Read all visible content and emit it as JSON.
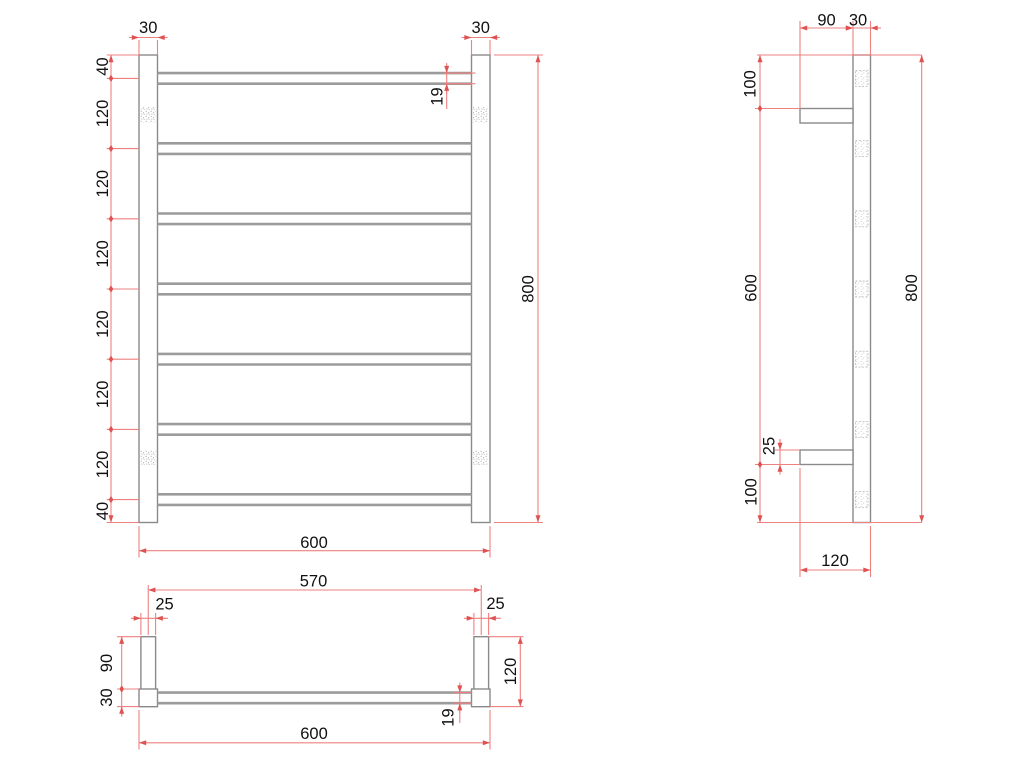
{
  "drawing_type": "technical-drawing",
  "subject": "ladder-towel-rail",
  "colors": {
    "background": "#ffffff",
    "dim_line": "#ef8080",
    "dim_arrow": "#e05252",
    "object_line": "#8a8a8a",
    "tube_line": "#9b9b9b",
    "object_fill": "#ffffff",
    "text": "#111111",
    "stipple_dot": "#b2b2b2",
    "stipple_dot_light": "#cfcfcf",
    "dash_border": "#c4c4c4"
  },
  "views": [
    {
      "name": "front-view",
      "rects": [
        {
          "n": "left-post",
          "x": 139,
          "y": 55,
          "w": 18.5,
          "h": 467.5
        },
        {
          "n": "right-post",
          "x": 471.5,
          "y": 55,
          "w": 18.5,
          "h": 467.5
        }
      ],
      "tube_lines": {
        "x1": 157.5,
        "x2": 471.5,
        "offset": 5.3,
        "centers": [
          78.4,
          148.6,
          218.8,
          289,
          359.2,
          429.4,
          499.6
        ]
      },
      "stipples": [
        {
          "x": 140.7,
          "y": 107,
          "w": 15.2,
          "h": 15.5
        },
        {
          "x": 140.7,
          "y": 450,
          "w": 15.2,
          "h": 15.5
        },
        {
          "x": 472.6,
          "y": 107,
          "w": 15.2,
          "h": 15.5
        },
        {
          "x": 472.6,
          "y": 450,
          "w": 15.2,
          "h": 15.5
        }
      ],
      "ext_lines": [
        [
          139,
          40,
          139,
          55
        ],
        [
          157.5,
          40,
          157.5,
          55
        ],
        [
          471.5,
          40,
          471.5,
          55
        ],
        [
          490,
          40,
          490,
          55
        ],
        [
          106.7,
          55,
          139,
          55
        ],
        [
          106.7,
          78.4,
          139,
          78.4
        ],
        [
          106.7,
          148.6,
          139,
          148.6
        ],
        [
          106.7,
          218.8,
          139,
          218.8
        ],
        [
          106.7,
          289,
          139,
          289
        ],
        [
          106.7,
          359.2,
          139,
          359.2
        ],
        [
          106.7,
          429.4,
          139,
          429.4
        ],
        [
          106.7,
          499.6,
          139,
          499.6
        ],
        [
          106.7,
          522.5,
          139,
          522.5
        ],
        [
          443,
          73.1,
          475.5,
          73.1
        ],
        [
          443,
          83.7,
          475.5,
          83.7
        ],
        [
          494,
          55,
          543,
          55
        ],
        [
          494,
          522.5,
          543,
          522.5
        ],
        [
          139,
          526,
          139,
          557.5
        ],
        [
          490,
          526,
          490,
          557.5
        ]
      ],
      "dims": [
        {
          "n": "post-width-left",
          "t": "30",
          "o": "h",
          "a": 139,
          "b": 157.5,
          "p": 37.5,
          "e": [
            "out",
            "out"
          ],
          "l": [
            148.2,
            28
          ]
        },
        {
          "n": "post-width-right",
          "t": "30",
          "o": "h",
          "a": 471.5,
          "b": 490,
          "p": 37.5,
          "e": [
            "out",
            "out"
          ],
          "l": [
            480.7,
            28
          ]
        },
        {
          "n": "top-rung-offset",
          "t": "40",
          "o": "v",
          "a": 55,
          "b": 78.4,
          "p": 111,
          "e": [
            "in",
            "diamond"
          ],
          "l": [
            103,
            66.5
          ]
        },
        {
          "n": "rung-pitch-1",
          "t": "120",
          "o": "v",
          "a": 78.4,
          "b": 148.6,
          "p": 111,
          "e": [
            "diamond",
            "diamond"
          ],
          "l": [
            103,
            113.5
          ]
        },
        {
          "n": "rung-pitch-2",
          "t": "120",
          "o": "v",
          "a": 148.6,
          "b": 218.8,
          "p": 111,
          "e": [
            "diamond",
            "diamond"
          ],
          "l": [
            103,
            183.7
          ]
        },
        {
          "n": "rung-pitch-3",
          "t": "120",
          "o": "v",
          "a": 218.8,
          "b": 289,
          "p": 111,
          "e": [
            "diamond",
            "diamond"
          ],
          "l": [
            103,
            253.9
          ]
        },
        {
          "n": "rung-pitch-4",
          "t": "120",
          "o": "v",
          "a": 289,
          "b": 359.2,
          "p": 111,
          "e": [
            "diamond",
            "diamond"
          ],
          "l": [
            103,
            324.1
          ]
        },
        {
          "n": "rung-pitch-5",
          "t": "120",
          "o": "v",
          "a": 359.2,
          "b": 429.4,
          "p": 111,
          "e": [
            "diamond",
            "diamond"
          ],
          "l": [
            103,
            394.3
          ]
        },
        {
          "n": "rung-pitch-6",
          "t": "120",
          "o": "v",
          "a": 429.4,
          "b": 499.6,
          "p": 111,
          "e": [
            "diamond",
            "diamond"
          ],
          "l": [
            103,
            464.5
          ]
        },
        {
          "n": "bottom-rung-offset",
          "t": "40",
          "o": "v",
          "a": 499.6,
          "b": 522.5,
          "p": 111,
          "e": [
            "diamond",
            "in"
          ],
          "l": [
            103,
            511
          ]
        },
        {
          "n": "tube-diameter",
          "t": "19",
          "o": "v",
          "a": 73.1,
          "b": 83.7,
          "p": 446.7,
          "e": [
            "out",
            "out"
          ],
          "l": [
            437.5,
            96.5
          ],
          "tail": [
            83.7,
            109
          ]
        },
        {
          "n": "overall-height",
          "t": "800",
          "o": "v",
          "a": 55,
          "b": 522.5,
          "p": 538,
          "e": [
            "in",
            "in"
          ],
          "l": [
            528.5,
            289
          ]
        },
        {
          "n": "overall-width",
          "t": "600",
          "o": "h",
          "a": 139,
          "b": 490,
          "p": 550.7,
          "e": [
            "in",
            "in"
          ],
          "l": [
            314,
            543
          ]
        }
      ]
    },
    {
      "name": "side-view",
      "rects": [
        {
          "n": "wall-rail",
          "x": 853,
          "y": 55,
          "w": 17.5,
          "h": 467.5
        },
        {
          "n": "upper-bracket",
          "x": 800,
          "y": 108.5,
          "w": 53,
          "h": 14.5
        },
        {
          "n": "lower-bracket",
          "x": 800,
          "y": 450,
          "w": 53,
          "h": 14.5
        }
      ],
      "dashed_squares": {
        "x": 855.5,
        "w": 12.5,
        "h": 16,
        "centers": [
          78.4,
          148.6,
          218.8,
          289,
          359.2,
          429.4,
          499.6
        ]
      },
      "ext_lines": [
        [
          800,
          21,
          800,
          108.5
        ],
        [
          853,
          21,
          853,
          55
        ],
        [
          870.5,
          21,
          870.5,
          55
        ],
        [
          757,
          55,
          921.7,
          55
        ],
        [
          757,
          522.5,
          921.7,
          522.5
        ],
        [
          755,
          108.5,
          800,
          108.5
        ],
        [
          755,
          464.5,
          800,
          464.5
        ],
        [
          775,
          450,
          800,
          450
        ],
        [
          800,
          468,
          800,
          577
        ],
        [
          870.5,
          526,
          870.5,
          577
        ]
      ],
      "dims": [
        {
          "n": "bracket-projection",
          "t": "90",
          "o": "h",
          "a": 800,
          "b": 853,
          "p": 28,
          "e": [
            "in",
            "in"
          ],
          "l": [
            826.5,
            20.5
          ]
        },
        {
          "n": "rail-depth",
          "t": "30",
          "o": "h",
          "a": 853,
          "b": 870.5,
          "p": 28,
          "e": [
            "out",
            "out"
          ],
          "l": [
            858,
            20.5
          ],
          "tail": [
            870.5,
            881
          ]
        },
        {
          "n": "top-bracket-offset",
          "t": "100",
          "o": "v",
          "a": 55,
          "b": 108.5,
          "p": 760,
          "e": [
            "in",
            "diamond"
          ],
          "l": [
            750.5,
            84
          ]
        },
        {
          "n": "bracket-spacing",
          "t": "600",
          "o": "v",
          "a": 108.5,
          "b": 464.5,
          "p": 760,
          "e": [
            "diamond",
            "diamond"
          ],
          "l": [
            751.5,
            288
          ]
        },
        {
          "n": "bottom-bracket-offset",
          "t": "100",
          "o": "v",
          "a": 464.5,
          "b": 522.5,
          "p": 760,
          "e": [
            "diamond",
            "in"
          ],
          "l": [
            751.5,
            492
          ]
        },
        {
          "n": "bracket-thickness",
          "t": "25",
          "o": "v",
          "a": 450,
          "b": 464.5,
          "p": 780,
          "e": [
            "out",
            "out"
          ],
          "l": [
            769.5,
            446
          ],
          "tail": [
            439,
            450
          ]
        },
        {
          "n": "overall-height",
          "t": "800",
          "o": "v",
          "a": 55,
          "b": 522.5,
          "p": 921.7,
          "e": [
            "in",
            "in"
          ],
          "l": [
            912,
            288
          ]
        },
        {
          "n": "wall-to-front",
          "t": "120",
          "o": "h",
          "a": 800,
          "b": 870.5,
          "p": 570,
          "e": [
            "in",
            "in"
          ],
          "l": [
            835,
            561
          ]
        }
      ]
    },
    {
      "name": "plan-view",
      "rects": [
        {
          "n": "left-bracket-arm",
          "x": 140.9,
          "y": 636.7,
          "w": 14.7,
          "h": 52.5
        },
        {
          "n": "right-bracket-arm",
          "x": 473.9,
          "y": 636.7,
          "w": 14.7,
          "h": 52.5
        },
        {
          "n": "left-post-section",
          "x": 139,
          "y": 689,
          "w": 18.5,
          "h": 17.7
        },
        {
          "n": "right-post-section",
          "x": 471.5,
          "y": 689,
          "w": 18.5,
          "h": 17.7
        }
      ],
      "tube_lines": {
        "x1": 157.5,
        "x2": 471.5,
        "offset": 5.3,
        "centers": [
          697.9
        ]
      },
      "ext_lines": [
        [
          148.25,
          585,
          148.25,
          635
        ],
        [
          481.25,
          585,
          481.25,
          635
        ],
        [
          140.9,
          613,
          140.9,
          635
        ],
        [
          155.6,
          613,
          155.6,
          635
        ],
        [
          473.9,
          613,
          473.9,
          635
        ],
        [
          488.6,
          613,
          488.6,
          635
        ],
        [
          117,
          636.7,
          140.9,
          636.7
        ],
        [
          117,
          689,
          139,
          689
        ],
        [
          117,
          706.6,
          139,
          706.6
        ],
        [
          488.6,
          636.7,
          523.5,
          636.7
        ],
        [
          490,
          706.6,
          523.5,
          706.6
        ],
        [
          454,
          692.6,
          471.5,
          692.6
        ],
        [
          454,
          703.2,
          471.5,
          703.2
        ],
        [
          139,
          710,
          139,
          749.5
        ],
        [
          490,
          710,
          490,
          749.5
        ]
      ],
      "dims": [
        {
          "n": "bracket-centres",
          "t": "570",
          "o": "h",
          "a": 148.25,
          "b": 481.25,
          "p": 590,
          "e": [
            "in",
            "in"
          ],
          "l": [
            313.5,
            581.5
          ]
        },
        {
          "n": "bracket-width-left",
          "t": "25",
          "o": "h",
          "a": 140.9,
          "b": 155.6,
          "p": 618.3,
          "e": [
            "out",
            "out"
          ],
          "l": [
            164.5,
            604.5
          ],
          "tail": [
            155.6,
            168
          ]
        },
        {
          "n": "bracket-width-right",
          "t": "25",
          "o": "h",
          "a": 473.9,
          "b": 488.6,
          "p": 618.3,
          "e": [
            "out",
            "out"
          ],
          "l": [
            495.5,
            604
          ],
          "tail": [
            488.6,
            501
          ]
        },
        {
          "n": "bracket-arm-depth",
          "t": "90",
          "o": "v",
          "a": 636.7,
          "b": 689,
          "p": 121.7,
          "e": [
            "in",
            "diamond"
          ],
          "l": [
            107,
            663
          ]
        },
        {
          "n": "post-depth",
          "t": "30",
          "o": "v",
          "a": 689,
          "b": 706.6,
          "p": 121.7,
          "e": [
            "diamond",
            "out"
          ],
          "l": [
            107,
            697.5
          ],
          "tail": [
            706.6,
            715
          ]
        },
        {
          "n": "overall-depth",
          "t": "120",
          "o": "v",
          "a": 636.7,
          "b": 706.6,
          "p": 520.3,
          "e": [
            "in",
            "in"
          ],
          "l": [
            511,
            671.5
          ]
        },
        {
          "n": "tube-diameter",
          "t": "19",
          "o": "v",
          "a": 692.6,
          "b": 703.2,
          "p": 459.8,
          "e": [
            "out",
            "out"
          ],
          "l": [
            448.5,
            717.5
          ],
          "tail": [
            703.2,
            723
          ]
        },
        {
          "n": "overall-width",
          "t": "600",
          "o": "h",
          "a": 139,
          "b": 490,
          "p": 742.8,
          "e": [
            "in",
            "in"
          ],
          "l": [
            314,
            734
          ]
        }
      ]
    }
  ]
}
